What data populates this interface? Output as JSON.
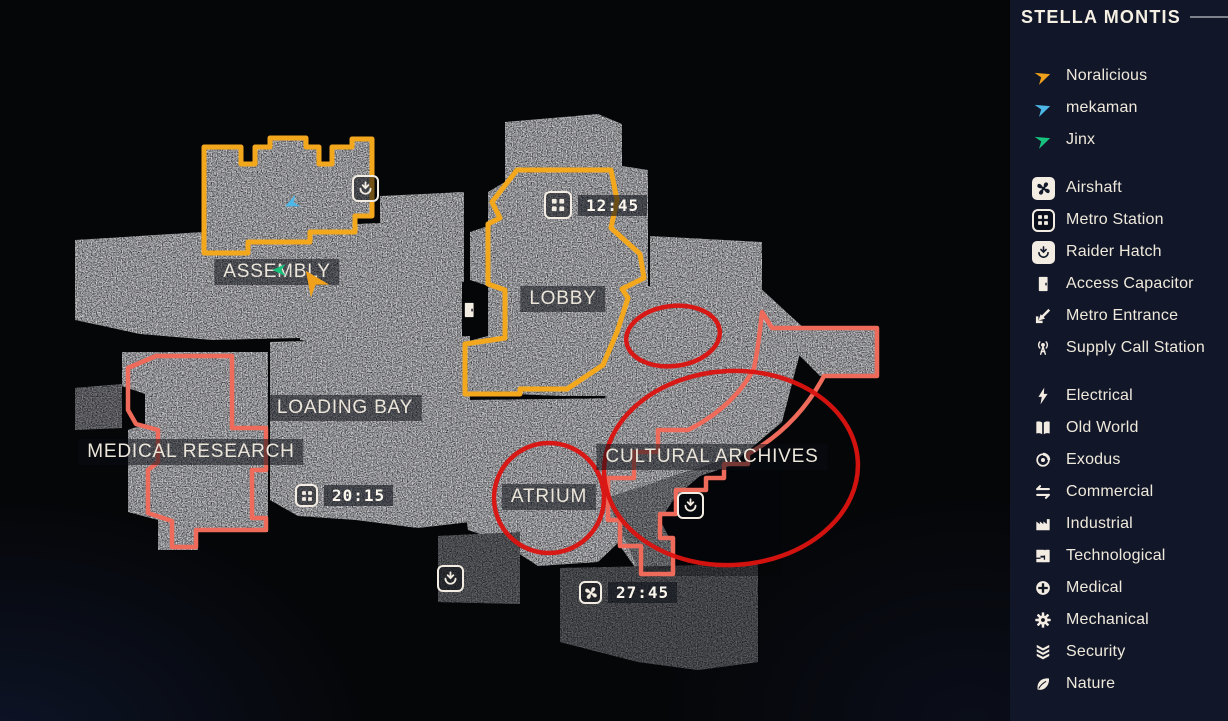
{
  "colors": {
    "region_yellow": "#f2a71c",
    "region_salmon": "#ee6a5a",
    "annotation_red": "#dc1310",
    "sidebar_bg": "#111628",
    "icon_light": "#f2ece2"
  },
  "sidebar": {
    "title": "STELLA MONTIS",
    "players": [
      {
        "name": "Noralicious",
        "icon": "player-arrow",
        "color": "#f0a11c"
      },
      {
        "name": "mekaman",
        "icon": "player-arrow",
        "color": "#4db8e8"
      },
      {
        "name": "Jinx",
        "icon": "player-arrow",
        "color": "#17c27d"
      }
    ],
    "markers": [
      {
        "icon": "airshaft",
        "style": "boxed-light",
        "label": "Airshaft"
      },
      {
        "icon": "metro-station",
        "style": "boxed-dark",
        "label": "Metro Station"
      },
      {
        "icon": "raider-hatch",
        "style": "boxed-light",
        "label": "Raider Hatch"
      },
      {
        "icon": "access-capacitor",
        "style": "plain",
        "label": "Access Capacitor"
      },
      {
        "icon": "metro-entrance",
        "style": "plain",
        "label": "Metro Entrance"
      },
      {
        "icon": "supply-call-station",
        "style": "plain",
        "label": "Supply Call Station"
      }
    ],
    "categories": [
      {
        "icon": "electrical",
        "label": "Electrical"
      },
      {
        "icon": "old-world",
        "label": "Old World"
      },
      {
        "icon": "exodus",
        "label": "Exodus"
      },
      {
        "icon": "commercial",
        "label": "Commercial"
      },
      {
        "icon": "industrial",
        "label": "Industrial"
      },
      {
        "icon": "technological",
        "label": "Technological"
      },
      {
        "icon": "medical",
        "label": "Medical"
      },
      {
        "icon": "mechanical",
        "label": "Mechanical"
      },
      {
        "icon": "security",
        "label": "Security"
      },
      {
        "icon": "nature",
        "label": "Nature"
      }
    ]
  },
  "map": {
    "labels": [
      {
        "text": "ASSEMBLY",
        "x": 277,
        "y": 272
      },
      {
        "text": "LOBBY",
        "x": 563,
        "y": 299
      },
      {
        "text": "LOADING BAY",
        "x": 345,
        "y": 408
      },
      {
        "text": "MEDICAL RESEARCH",
        "x": 191,
        "y": 452
      },
      {
        "text": "ATRIUM",
        "x": 549,
        "y": 497
      },
      {
        "text": "CULTURAL ARCHIVES",
        "x": 712,
        "y": 457
      }
    ],
    "timers": [
      {
        "icon": "metro-station",
        "time": "12:45",
        "x": 544,
        "y": 191,
        "size": 28
      },
      {
        "icon": "metro-station",
        "time": "20:15",
        "x": 295,
        "y": 484,
        "size": 23
      },
      {
        "icon": "airshaft",
        "time": "27:45",
        "x": 579,
        "y": 581,
        "size": 23
      }
    ],
    "markers": [
      {
        "icon": "raider-hatch",
        "x": 352,
        "y": 175,
        "size": 27
      },
      {
        "icon": "raider-hatch",
        "x": 437,
        "y": 565,
        "size": 27
      },
      {
        "icon": "raider-hatch",
        "x": 677,
        "y": 492,
        "size": 27
      },
      {
        "icon": "access-capacitor",
        "x": 458,
        "y": 299,
        "size": 22
      }
    ],
    "players": [
      {
        "name": "Noralicious",
        "color": "#f0a11c",
        "x": 313,
        "y": 281,
        "angle": -125,
        "size": 30
      },
      {
        "name": "mekaman",
        "color": "#4db8e8",
        "x": 291,
        "y": 203,
        "angle": 155,
        "size": 17
      },
      {
        "name": "Jinx",
        "color": "#17c27d",
        "x": 279,
        "y": 270,
        "angle": 180,
        "size": 16
      }
    ],
    "annotations": [
      {
        "type": "circle",
        "cx": 549,
        "cy": 498,
        "r": 55
      },
      {
        "type": "ellipse",
        "cx": 673,
        "cy": 336,
        "rx": 47,
        "ry": 30,
        "rot": -7
      },
      {
        "type": "ellipse",
        "cx": 731,
        "cy": 468,
        "rx": 127,
        "ry": 97,
        "rot": -3
      }
    ]
  }
}
